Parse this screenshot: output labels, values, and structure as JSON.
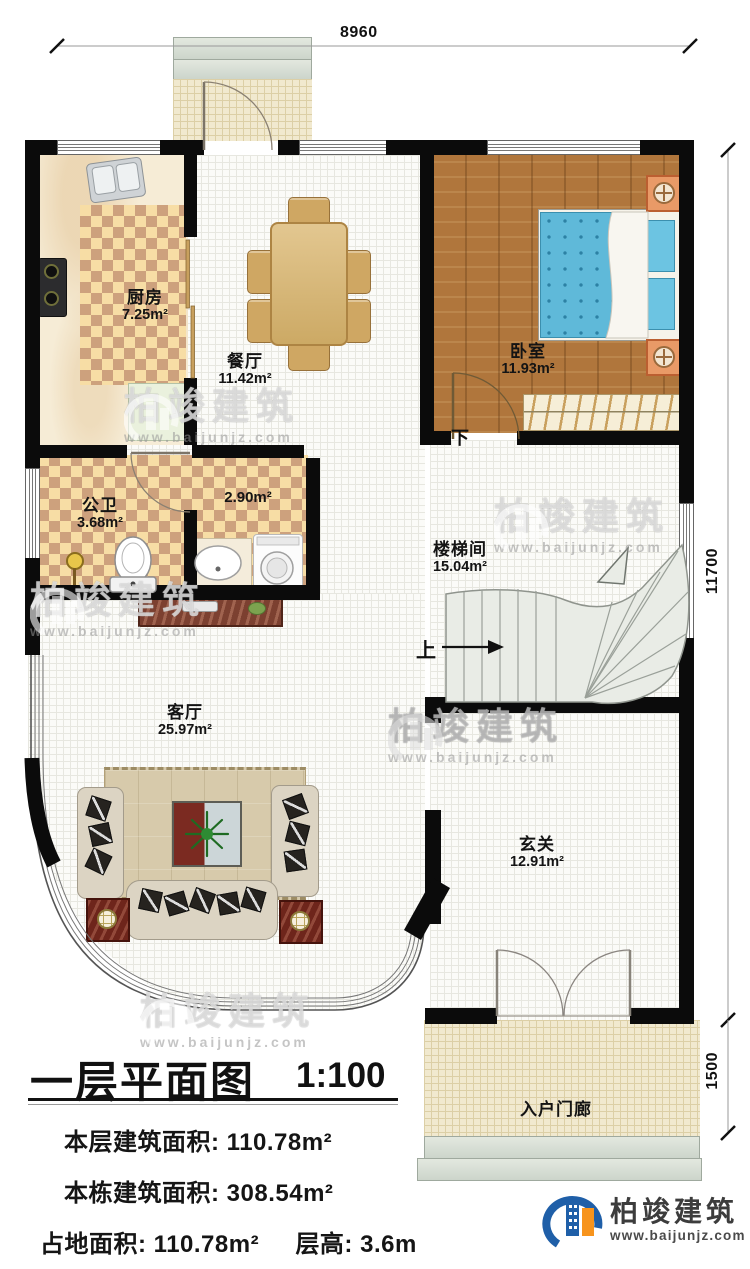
{
  "dimensions": {
    "top": "8960",
    "side_main": "11700",
    "side_porch": "1500"
  },
  "rooms": [
    {
      "id": "kitchen",
      "name": "厨房",
      "area": "7.25m²"
    },
    {
      "id": "dining",
      "name": "餐厅",
      "area": "11.42m²"
    },
    {
      "id": "bedroom",
      "name": "卧室",
      "area": "11.93m²"
    },
    {
      "id": "bath",
      "name": "公卫",
      "area": "3.68m²"
    },
    {
      "id": "utility",
      "name": "",
      "area": "2.90m²"
    },
    {
      "id": "stair",
      "name": "楼梯间",
      "area": "15.04m²"
    },
    {
      "id": "living",
      "name": "客厅",
      "area": "25.97m²"
    },
    {
      "id": "foyer",
      "name": "玄关",
      "area": "12.91m²"
    },
    {
      "id": "porch",
      "name": "入户门廊",
      "area": ""
    }
  ],
  "annotations": {
    "up": "上",
    "down": "下"
  },
  "title_block": {
    "title": "一层平面图",
    "scale": "1:100",
    "row1_label": "本层建筑面积:",
    "row1_value": "110.78m²",
    "row2_label": "本栋建筑面积:",
    "row2_value": "308.54m²",
    "row3_label": "占地面积:",
    "row3_value": "110.78m²",
    "row3b_label": "层高:",
    "row3b_value": "3.6m"
  },
  "branding": {
    "logo_text": "柏竣建筑",
    "website": "www.baijunjz.com",
    "blue": "#1f5fa8",
    "orange": "#f7941d"
  },
  "watermark": {
    "text": "柏竣建筑",
    "website": "www.baijunjz.com"
  }
}
